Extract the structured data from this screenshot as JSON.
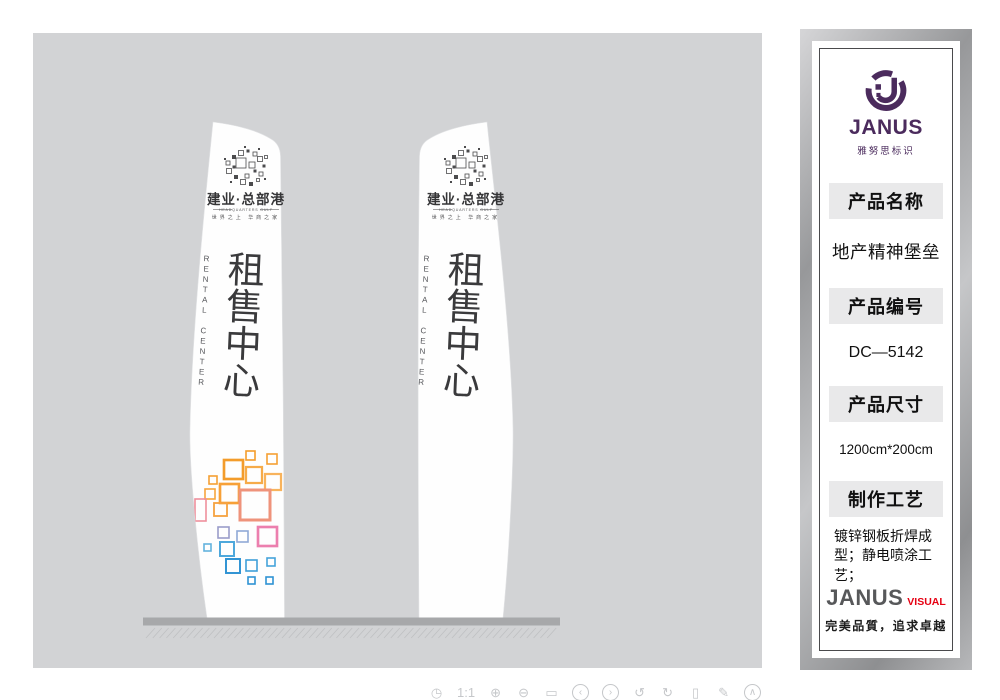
{
  "canvas": {
    "bg": "#d2d3d5",
    "pylon": {
      "brand_name": "建业·总部港",
      "brand_en": "HEADQUARTERS GULF",
      "brand_slogan": "世界之上 华商之家",
      "title": "租售中心",
      "subtitle": "RENTAL CENTER",
      "title_color": "#3a3a3c"
    },
    "squares": [
      [
        246,
        451,
        9,
        9,
        "#f39c2b"
      ],
      [
        267,
        454,
        10,
        10,
        "#f5a033"
      ],
      [
        224,
        460,
        19,
        19,
        "#f39c2b"
      ],
      [
        246,
        467,
        16,
        16,
        "#f6ab49"
      ],
      [
        209,
        476,
        8,
        8,
        "#f5a033"
      ],
      [
        265,
        474,
        16,
        16,
        "#f8b35c"
      ],
      [
        205,
        489,
        10,
        10,
        "#f6a53d"
      ],
      [
        220,
        484,
        19,
        19,
        "#f7a037"
      ],
      [
        240,
        490,
        30,
        30,
        "#ef937b"
      ],
      [
        214,
        503,
        13,
        13,
        "#f6a341"
      ],
      [
        195,
        499,
        11,
        22,
        "#ee8f9d"
      ],
      [
        218,
        527,
        11,
        11,
        "#9a9cca"
      ],
      [
        237,
        531,
        11,
        11,
        "#8fa8d6"
      ],
      [
        258,
        527,
        19,
        19,
        "#ec7fae"
      ],
      [
        204,
        544,
        7,
        7,
        "#63b2de"
      ],
      [
        220,
        542,
        14,
        14,
        "#4aa6db"
      ],
      [
        226,
        559,
        14,
        14,
        "#2f93d4"
      ],
      [
        246,
        560,
        11,
        11,
        "#3f9fd8"
      ],
      [
        267,
        558,
        8,
        8,
        "#45a3da"
      ],
      [
        248,
        577,
        7,
        7,
        "#2f93d4"
      ],
      [
        266,
        577,
        7,
        7,
        "#2f93d4"
      ]
    ],
    "toolbar": [
      {
        "name": "history-icon",
        "glyph": "◷",
        "circled": false
      },
      {
        "name": "actual-size-icon",
        "glyph": "1:1",
        "circled": false
      },
      {
        "name": "zoom-in-icon",
        "glyph": "⊕",
        "circled": false
      },
      {
        "name": "zoom-out-icon",
        "glyph": "⊖",
        "circled": false
      },
      {
        "name": "preview-icon",
        "glyph": "▭",
        "circled": false
      },
      {
        "name": "prev-icon",
        "glyph": "‹",
        "circled": true
      },
      {
        "name": "next-icon",
        "glyph": "›",
        "circled": true
      },
      {
        "name": "undo-icon",
        "glyph": "↺",
        "circled": false
      },
      {
        "name": "redo-icon",
        "glyph": "↻",
        "circled": false
      },
      {
        "name": "delete-icon",
        "glyph": "▯",
        "circled": false
      },
      {
        "name": "edit-icon",
        "glyph": "✎",
        "circled": false
      },
      {
        "name": "collapse-icon",
        "glyph": "∧",
        "circled": true
      }
    ]
  },
  "panel": {
    "logo": {
      "name": "JANUS",
      "subtitle": "雅努思标识",
      "color": "#4b2b5d"
    },
    "sections": [
      {
        "label": "产品名称",
        "value": "地产精神堡垒"
      },
      {
        "label": "产品编号",
        "value": "DC—5142"
      },
      {
        "label": "产品尺寸",
        "value": "1200cm*200cm"
      },
      {
        "label": "制作工艺",
        "value": "镀锌钢板折焊成型；静电喷涂工艺；"
      }
    ],
    "footer": {
      "brand": "JANUS",
      "brand_suffix": "VISUAL",
      "accent": "#e60012",
      "slogan": "完美品質，追求卓越"
    }
  }
}
